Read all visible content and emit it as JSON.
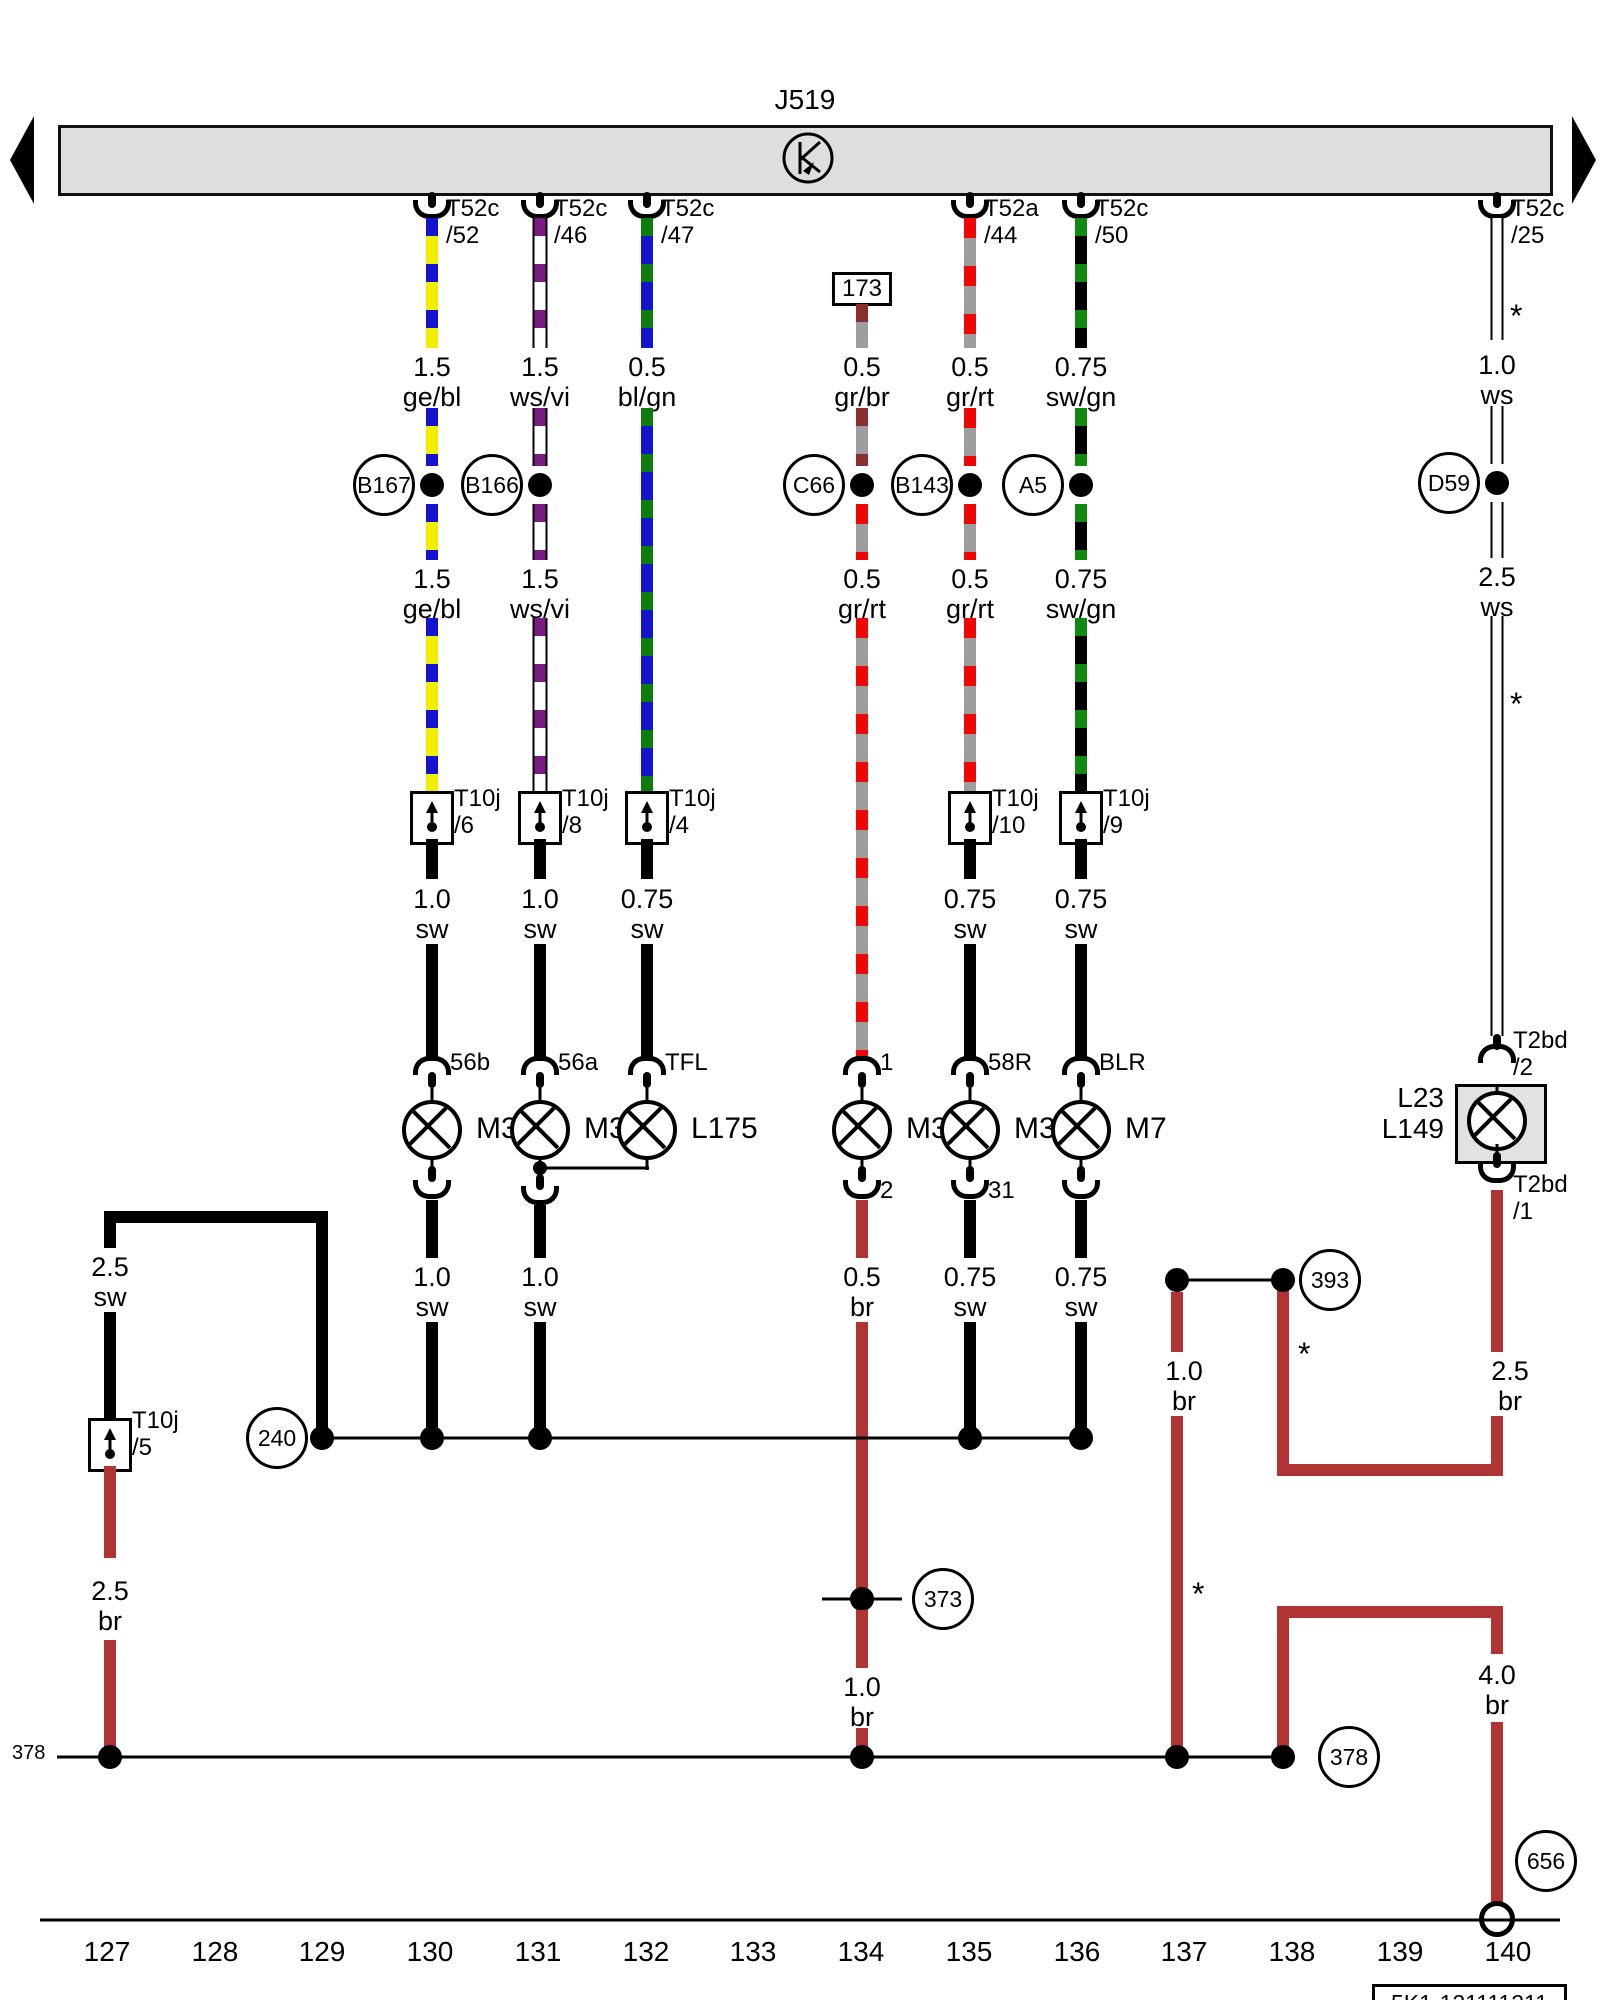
{
  "bus": {
    "component": "J519"
  },
  "symbols": {
    "asterisk": "*"
  },
  "connectors": {
    "bus": {
      "c1": "T52c\n/52",
      "c2": "T52c\n/46",
      "c3": "T52c\n/47",
      "c5": "T52a\n/44",
      "c6": "T52c\n/50",
      "c7": "T52c\n/25"
    },
    "inline": {
      "c1": "T10j\n/6",
      "c2": "T10j\n/8",
      "c3": "T10j\n/4",
      "c5": "T10j\n/10",
      "c6": "T10j\n/9",
      "left": "T10j\n/5"
    },
    "lamp_right": {
      "in": "T2bd\n/2",
      "out": "T2bd\n/1"
    }
  },
  "ref_track_173": "173",
  "wire_labels": {
    "c1_top": "1.5\nge/bl",
    "c1_mid": "1.5\nge/bl",
    "c1_sw": "1.0\nsw",
    "c1_low": "1.0\nsw",
    "c2_top": "1.5\nws/vi",
    "c2_mid": "1.5\nws/vi",
    "c2_sw": "1.0\nsw",
    "c2_low": "1.0\nsw",
    "c3_top": "0.5\nbl/gn",
    "c3_sw": "0.75\nsw",
    "c4_top": "0.5\ngr/br",
    "c4_mid": "0.5\ngr/rt",
    "c4_low": "0.5\nbr",
    "c4_gnd": "1.0\nbr",
    "c5_top": "0.5\ngr/rt",
    "c5_mid": "0.5\ngr/rt",
    "c5_sw": "0.75\nsw",
    "c5_low": "0.75\nsw",
    "c6_top": "0.75\nsw/gn",
    "c6_mid": "0.75\nsw/gn",
    "c6_sw": "0.75\nsw",
    "c6_low": "0.75\nsw",
    "c7_top": "1.0\nws",
    "c7_mid": "2.5\nws",
    "c7_br": "2.5\nbr",
    "left_sw": "2.5\nsw",
    "left_br": "2.5\nbr",
    "g1_br": "1.0\nbr",
    "g2_br": "4.0\nbr"
  },
  "splices": {
    "b167": "B167",
    "b166": "B166",
    "c66": "C66",
    "b143": "B143",
    "a5": "A5",
    "d59": "D59"
  },
  "terminals": {
    "c1": "56b",
    "c2": "56a",
    "c3": "TFL",
    "c4_in": "1",
    "c4_out": "2",
    "c5_in": "58R",
    "c5_out": "31",
    "c6": "BLR"
  },
  "lamps": {
    "m31": "M31",
    "m32": "M32",
    "l175": "L175",
    "m34": "M34",
    "m3": "M3",
    "m7": "M7",
    "right_box": "L23\nL149"
  },
  "grounds": {
    "g240": "240",
    "g373": "373",
    "g378": "378",
    "g393": "393",
    "g656": "656",
    "row_label": "378"
  },
  "tracks": [
    "127",
    "128",
    "129",
    "130",
    "131",
    "132",
    "133",
    "134",
    "135",
    "136",
    "137",
    "138",
    "139",
    "140"
  ],
  "part_code": "5K1-121111211",
  "colors": {
    "brown_wire": "#b13434",
    "grey": "#9d9d9d",
    "red": "#ee0600",
    "yellow": "#f2ee00",
    "blue": "#1414cf",
    "green": "#0f8a0f",
    "violet": "#7d1b85",
    "bus_fill": "#dedede"
  }
}
